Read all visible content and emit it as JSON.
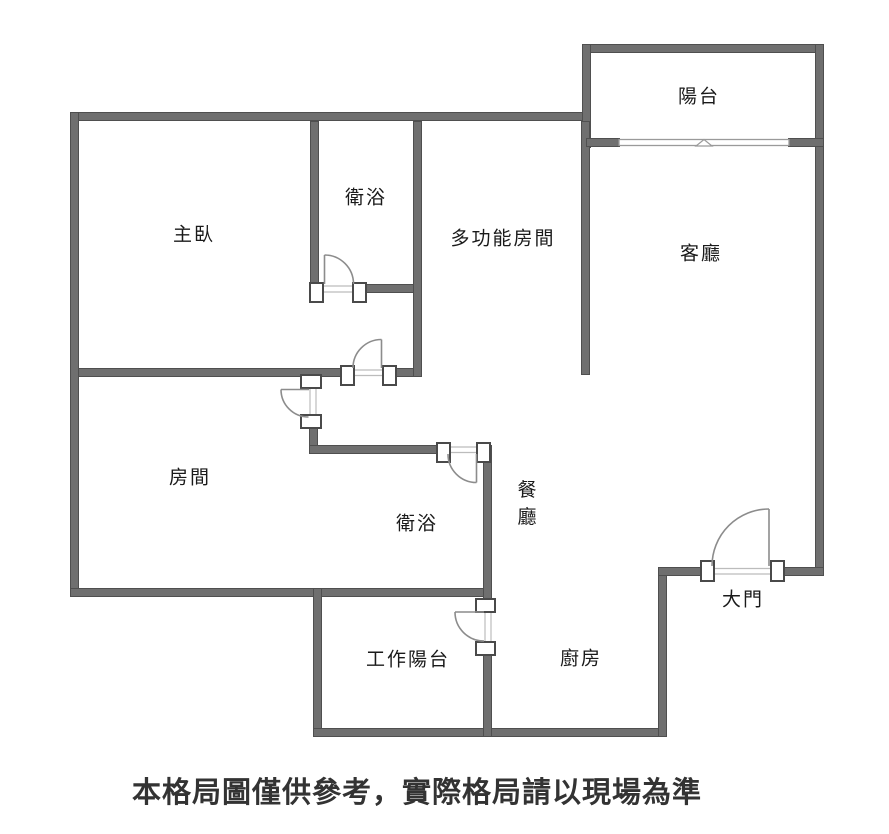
{
  "floorplan": {
    "rooms": [
      {
        "name": "balcony",
        "label": "陽台"
      },
      {
        "name": "master-bedroom",
        "label": "主臥"
      },
      {
        "name": "bathroom-1",
        "label": "衛浴"
      },
      {
        "name": "multifunction-room",
        "label": "多功能房間"
      },
      {
        "name": "living-room",
        "label": "客廳"
      },
      {
        "name": "bedroom",
        "label": "房間"
      },
      {
        "name": "bathroom-2",
        "label": "衛浴"
      },
      {
        "name": "dining-room",
        "label": "餐廳"
      },
      {
        "name": "main-door",
        "label": "大門"
      },
      {
        "name": "utility-balcony",
        "label": "工作陽台"
      },
      {
        "name": "kitchen",
        "label": "廚房"
      }
    ],
    "caption": "本格局圖僅供參考，實際格局請以現場為準",
    "window": {
      "marker": "triangle-up"
    },
    "colors": {
      "wall": "#6f6f6f",
      "wall_edge": "#4f4f4f",
      "jamb_border": "#4a4a4a",
      "door_line": "#8c8c8c",
      "threshold": "#bcbcbc",
      "window_line": "#9a9a9a",
      "text": "#1a1a1a",
      "caption": "#333333",
      "background": "#ffffff"
    }
  }
}
